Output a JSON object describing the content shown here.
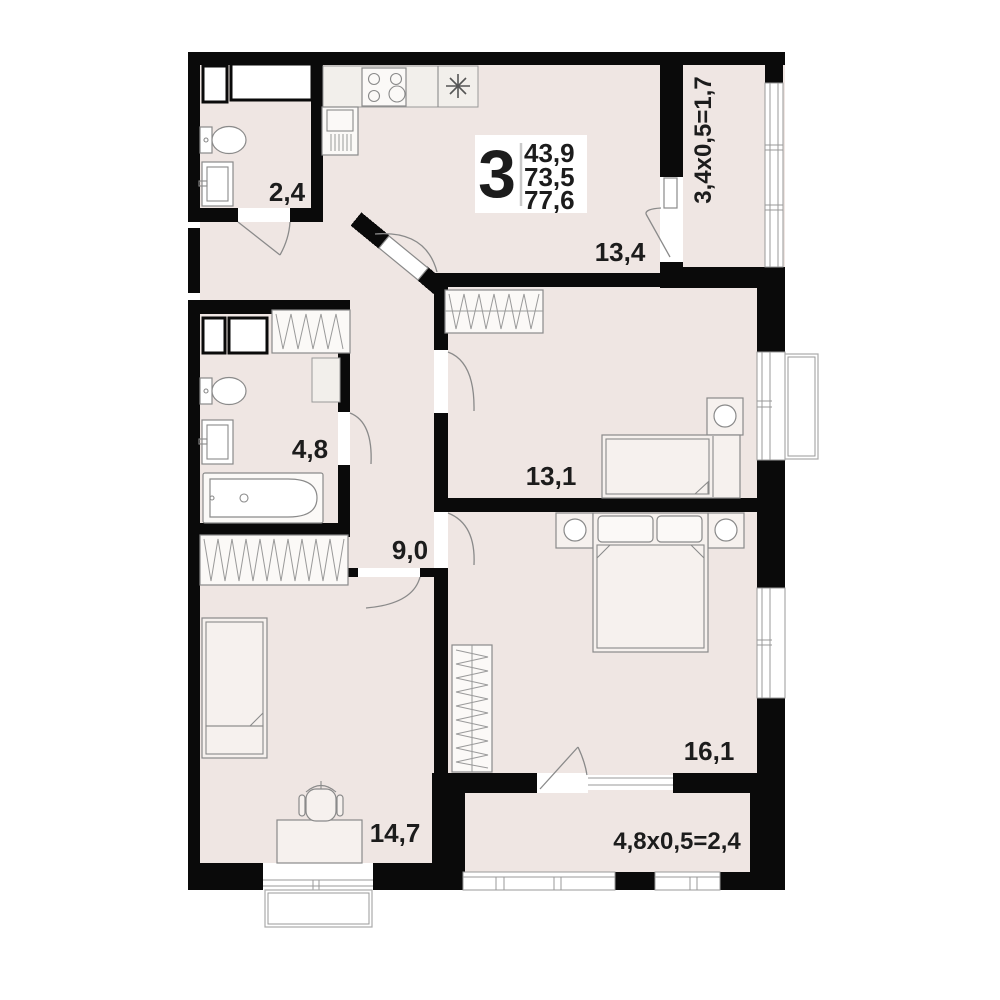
{
  "plan": {
    "info_box": {
      "rooms_count": "3",
      "areas": [
        "43,9",
        "73,5",
        "77,6"
      ]
    },
    "rooms": {
      "wc": "2,4",
      "kitchen_living": "13,4",
      "bathroom": "4,8",
      "bedroom_1": "13,1",
      "hallway": "9,0",
      "bedroom_2": "16,1",
      "bedroom_3": "14,7"
    },
    "balconies": {
      "top": "3,4x0,5=1,7",
      "bottom": "4,8x0,5=2,4"
    },
    "colors": {
      "floor": "#EFE6E3",
      "walls": "#0A0A0A",
      "outlines": "#8A8A8A",
      "text": "#1C1C1C",
      "background": "#FFFFFF"
    },
    "icons": {
      "stove": "four-burner-cooktop",
      "kitchen_sink": "asterisk-star",
      "fridge": "tall-cabinet-hatched",
      "toilet": "toilet-top-view",
      "washbasin": "sink-top-view",
      "bathtub": "bathtub-top-view",
      "wardrobe": "zigzag-hatch",
      "bed": "bed-top-view",
      "desk_chair": "office-chair-top-view"
    }
  }
}
